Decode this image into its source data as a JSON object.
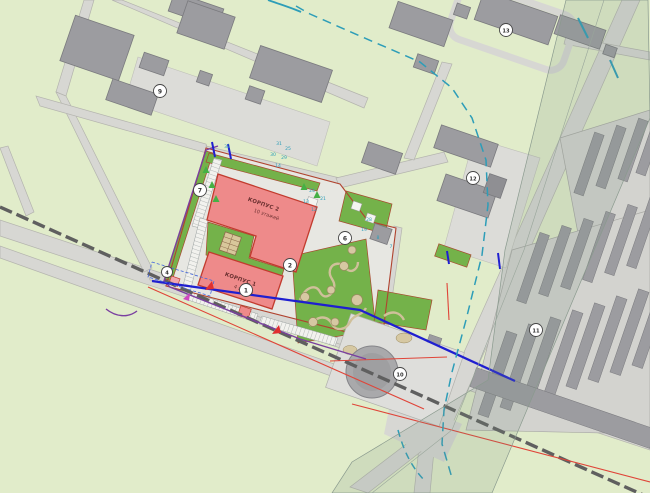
{
  "plan": {
    "type": "site-master-plan",
    "buildings": {
      "korpus2": {
        "name": "КОРПУС 2",
        "floors": "10 этажей"
      },
      "korpus1": {
        "name": "КОРПУС 1",
        "floors": "4 этажа"
      }
    },
    "callouts": {
      "c1": "1",
      "c2": "2",
      "c4": "4",
      "c6": "6",
      "c7": "7",
      "c9": "9",
      "c10": "10",
      "c11": "11",
      "c12": "12",
      "c13": "13"
    },
    "utility_labels": {
      "u32": "32",
      "u31": "31",
      "u25": "25",
      "u30": "30",
      "u29": "29",
      "u14": "14",
      "u24": "24",
      "u21": "21",
      "u13": "13",
      "u12": "12",
      "u28": "28",
      "u19": "19",
      "u8": "8",
      "u7": "7"
    },
    "colors": {
      "background": "#e1ecca",
      "site_green": "#74b24a",
      "building_red": "#ee8a8a",
      "building_gray": "#9c9ca0",
      "road": "#d7d7d3",
      "railway": "#5f5f5f",
      "site_border": "#b0432f",
      "boundary_purple": "#7a3fa0",
      "utility_blue": "#1f1fd0",
      "utility_red": "#e04438",
      "utility_teal": "#2d9db8",
      "path_tan": "#cfc09a"
    }
  }
}
